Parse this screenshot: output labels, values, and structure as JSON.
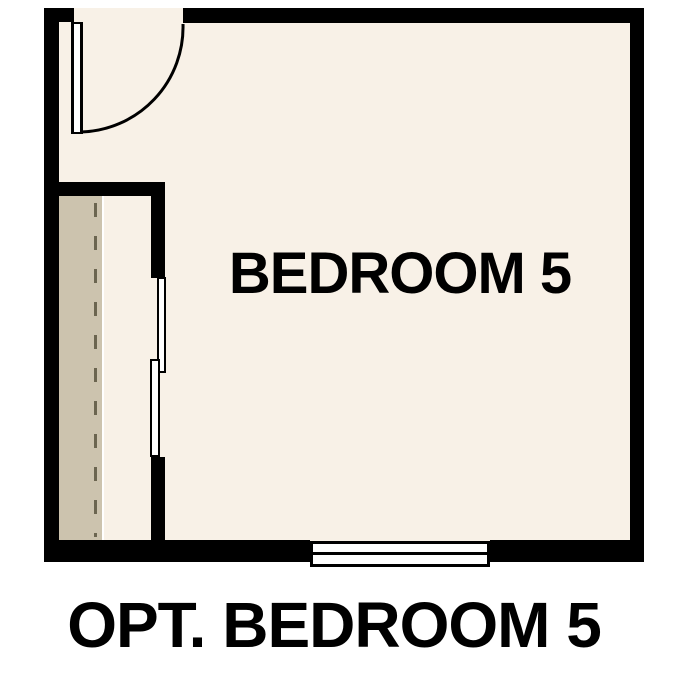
{
  "labels": {
    "room": "BEDROOM 5",
    "caption": "OPT. BEDROOM 5"
  },
  "colors": {
    "wall": "#000000",
    "floor": "#f8f1e7",
    "closet_shelf": "#ccc3ae",
    "closet_rod": "#6b6550",
    "door_window_fill": "#ffffff",
    "text": "#000000",
    "background": "#ffffff"
  }
}
